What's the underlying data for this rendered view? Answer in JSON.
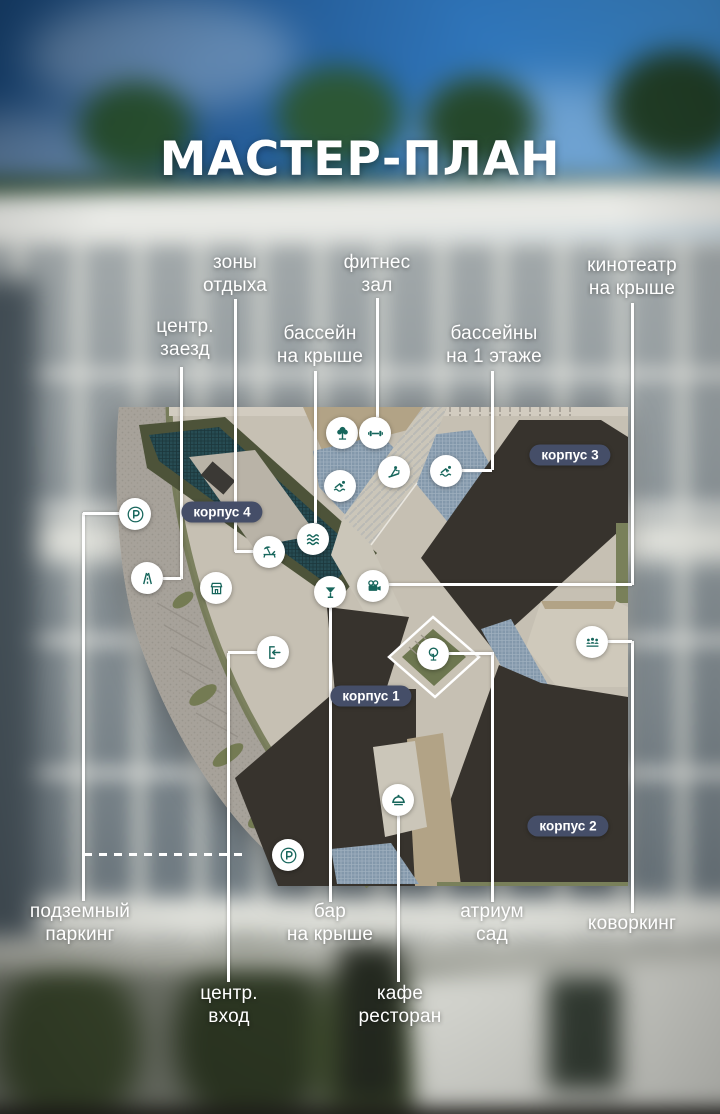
{
  "title": "МАСТЕР-ПЛАН",
  "colors": {
    "accent_teal": "#17665c",
    "badge_navy": "#454e68",
    "callout_white": "#ffffff",
    "building_dark": "#37332d",
    "pool_dark_teal": "#274c53",
    "pool_light_blue": "#8398ab"
  },
  "callouts": {
    "zones": {
      "line1": "зоны",
      "line2": "отдыха"
    },
    "fitness": {
      "line1": "фитнес",
      "line2": "зал"
    },
    "cinema": {
      "line1": "кинотеатр",
      "line2": "на крыше"
    },
    "drive": {
      "line1": "центр.",
      "line2": "заезд"
    },
    "roofpool": {
      "line1": "бассейн",
      "line2": "на крыше"
    },
    "floorpools": {
      "line1": "бассейны",
      "line2": "на 1 этаже"
    },
    "parking": {
      "line1": "подземный",
      "line2": "паркинг"
    },
    "bar": {
      "line1": "бар",
      "line2": "на крыше"
    },
    "atrium": {
      "line1": "атриум",
      "line2": "сад"
    },
    "coworking": {
      "line1": "коворкинг",
      "line2": ""
    },
    "entrance": {
      "line1": "центр.",
      "line2": "вход"
    },
    "cafe": {
      "line1": "кафе",
      "line2": "ресторан"
    }
  },
  "buildings": {
    "k1": {
      "label": "корпус 1"
    },
    "k2": {
      "label": "корпус 2"
    },
    "k3": {
      "label": "корпус 3"
    },
    "k4": {
      "label": "корпус 4"
    }
  },
  "map_icons": [
    {
      "name": "parking-icon"
    },
    {
      "name": "road-icon"
    },
    {
      "name": "shop-icon"
    },
    {
      "name": "lounge-icon"
    },
    {
      "name": "waves-icon"
    },
    {
      "name": "tree-icon"
    },
    {
      "name": "dumbbell-icon"
    },
    {
      "name": "swimmer-icon"
    },
    {
      "name": "treadmill-icon"
    },
    {
      "name": "cocktail-icon"
    },
    {
      "name": "cinema-camera-icon"
    },
    {
      "name": "entrance-door-icon"
    },
    {
      "name": "atrium-tree-icon"
    },
    {
      "name": "coworking-people-icon"
    },
    {
      "name": "restaurant-cloche-icon"
    }
  ]
}
